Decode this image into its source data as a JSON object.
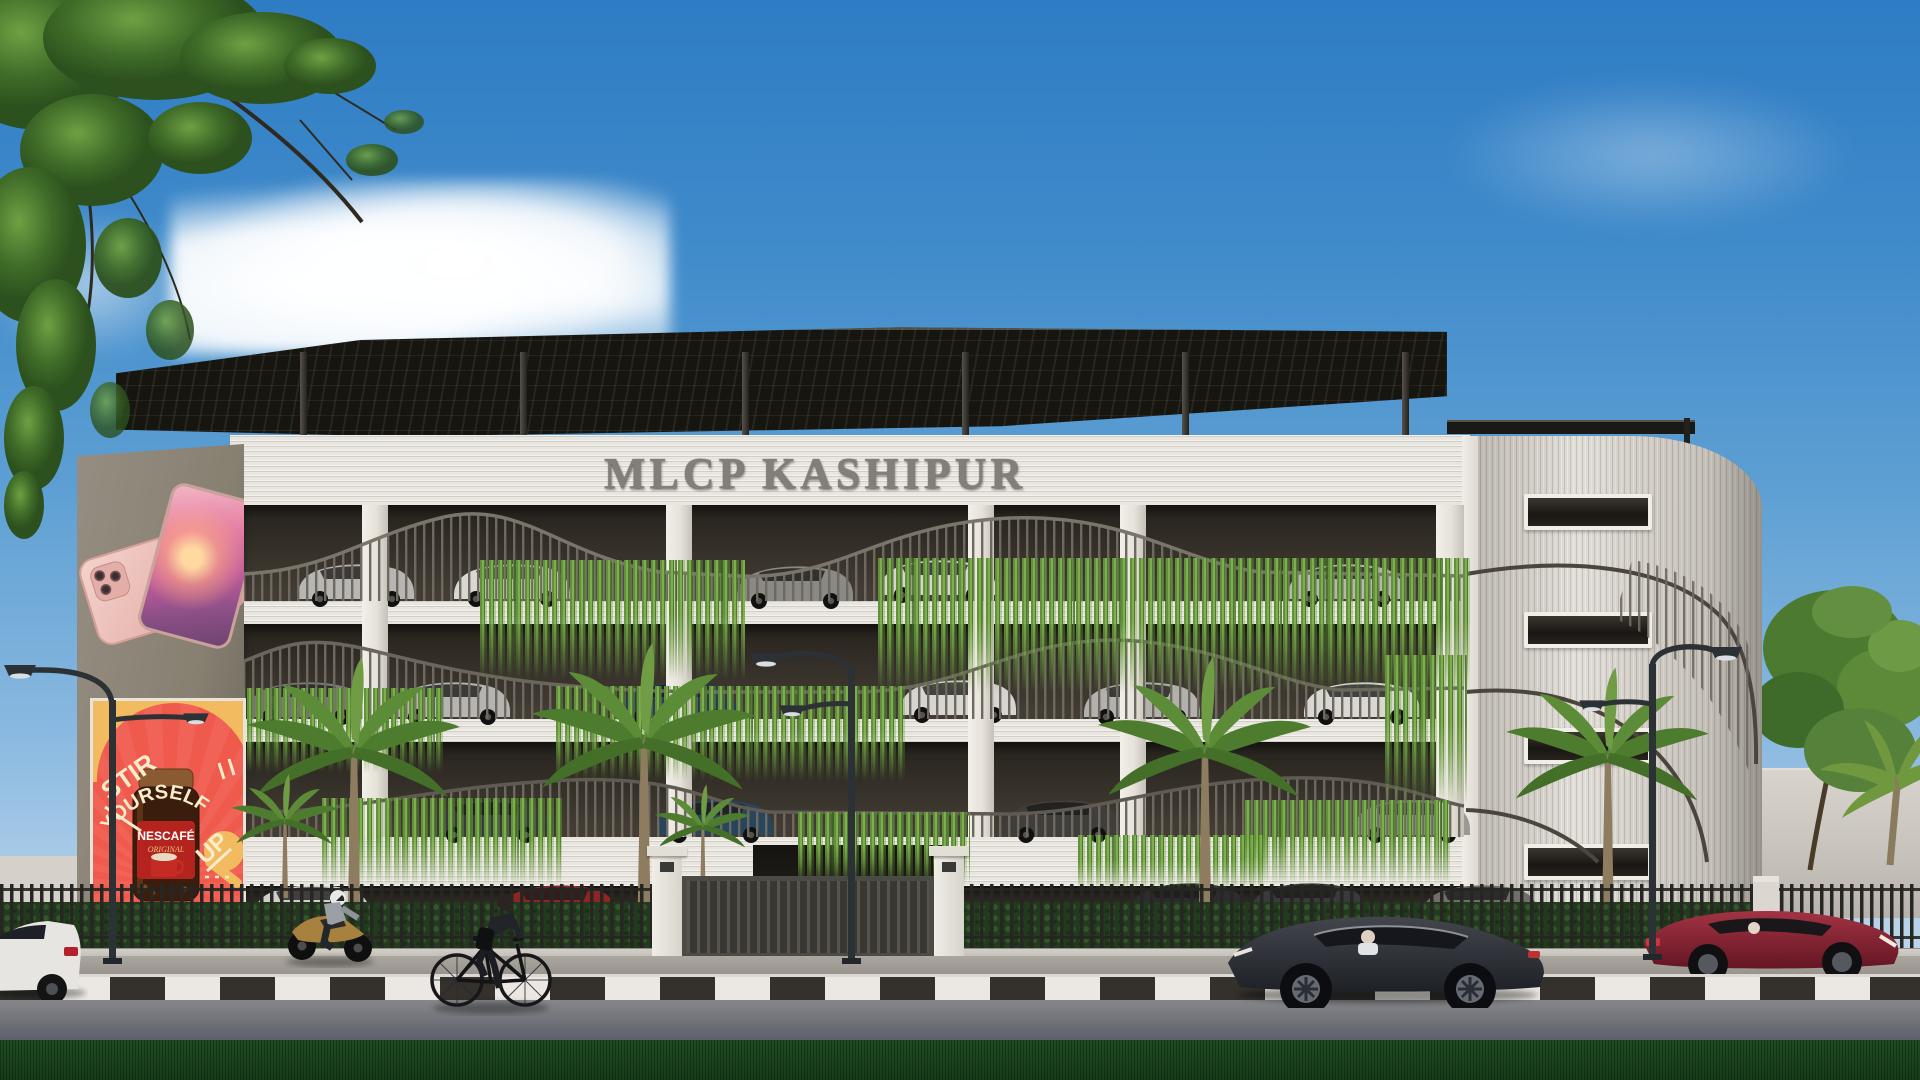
{
  "scene": {
    "type": "architectural rendering",
    "subject": "multi-level car parking building, street view"
  },
  "building": {
    "sign_text": "MLCP KASHIPUR",
    "parking_levels_visible": 4
  },
  "billboards": {
    "phone_ad": {
      "content": "two rose-gold smartphones on grey pylon"
    },
    "nescafe_ad": {
      "headline_line1": "STIR",
      "headline_line2": "YOURSELF",
      "headline_line3": "UP",
      "brand": "NESCAFÉ",
      "variant": "ORIGINAL"
    }
  },
  "street": {
    "vehicles": [
      "white sedan",
      "gold motorcycle with rider",
      "cyclist in dark suit",
      "dark grey sedan",
      "red sedan"
    ],
    "furniture": [
      "double-arm street lights",
      "black picket fence",
      "sliding entrance gate",
      "black-and-white kerb"
    ]
  },
  "colors": {
    "sky_top": "#2e7cc4",
    "sky_horizon": "#cfdfee",
    "canopy": "#16150f",
    "facade": "#e9e6e0",
    "interior": "#332e27",
    "vines": "#6a9b3c",
    "pylon_grey": "#8a8177",
    "nescafe_red": "#ef5a4c",
    "nescafe_yellow": "#f2bb60",
    "cream_text": "#f8ecca",
    "sign_grey": "#827e79",
    "grass": "#1c451d",
    "road": "#6d6f78"
  }
}
